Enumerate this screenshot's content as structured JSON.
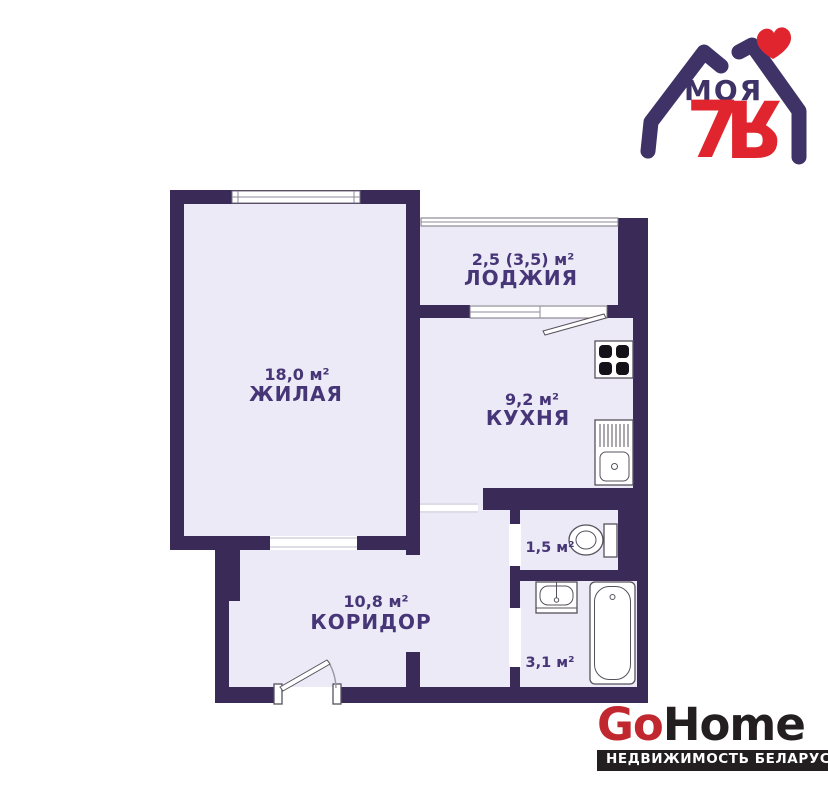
{
  "brand_logo": {
    "title": "МОЯ",
    "seven": "7",
    "ya": "Я",
    "heart_icon": "heart",
    "color_purple": "#3e3266",
    "color_red": "#e0252e"
  },
  "floor_plan": {
    "rooms": [
      {
        "id": "living",
        "name": "ЖИЛАЯ",
        "area": "18,0 м²"
      },
      {
        "id": "loggia",
        "name": "ЛОДЖИЯ",
        "area": "2,5 (3,5) м²"
      },
      {
        "id": "kitchen",
        "name": "КУХНЯ",
        "area": "9,2 м²"
      },
      {
        "id": "corridor",
        "name": "КОРИДОР",
        "area": "10,8 м²"
      },
      {
        "id": "toilet",
        "name": "",
        "area": "1,5 м²"
      },
      {
        "id": "bathroom",
        "name": "",
        "area": "3,1 м²"
      }
    ],
    "fixtures": [
      "stove-icon",
      "kitchen-sink-icon",
      "toilet-icon",
      "washbasin-icon",
      "bathtub-icon"
    ],
    "colors": {
      "wall": "#392a58",
      "room_fill": "#eceaf7",
      "label": "#473677"
    }
  },
  "footer_logo": {
    "go": "Go",
    "home": "Home",
    "tagline": "НЕДВИЖИМОСТЬ БЕЛАРУСИ",
    "go_color": "#c0272f",
    "dark_color": "#231f20"
  }
}
